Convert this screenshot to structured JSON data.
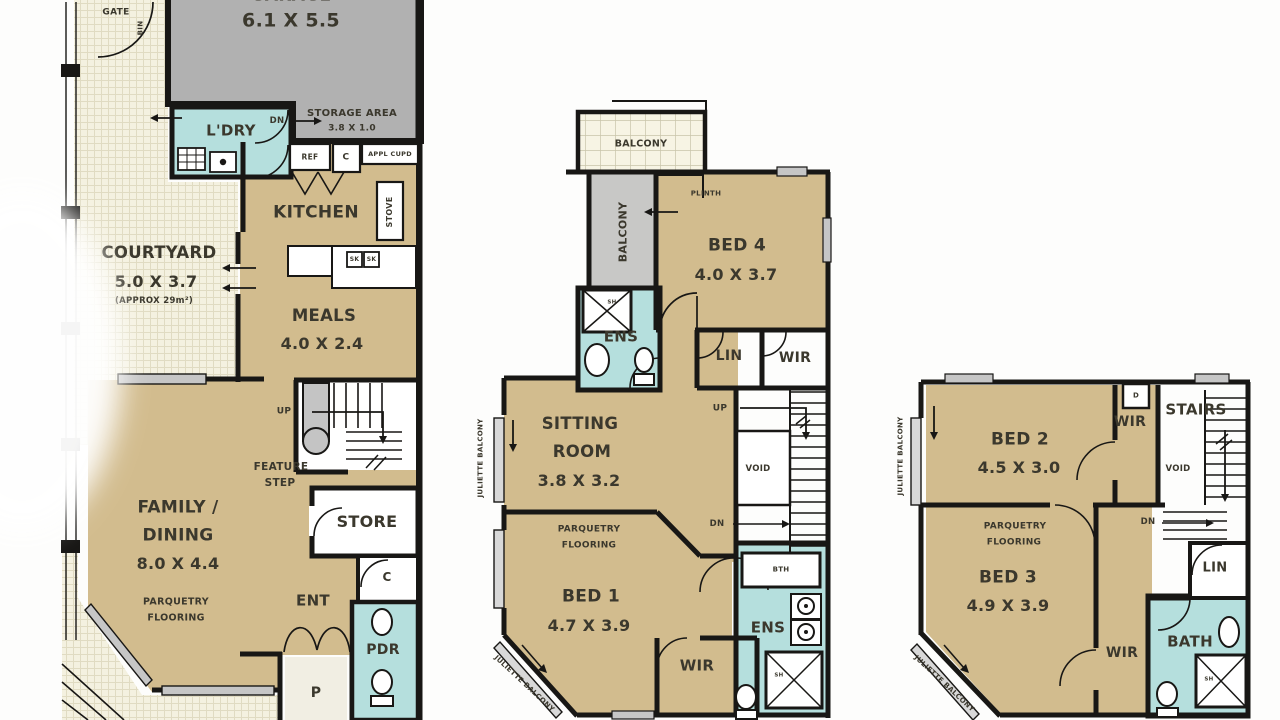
{
  "common": {
    "balcony": "BALCONY",
    "juliette": "JULIETTE BALCONY",
    "parquetry1": "PARQUETRY",
    "parquetry2": "FLOORING",
    "wir": "WIR",
    "ens": "ENS",
    "lin": "LIN",
    "void": "VOID",
    "up": "UP",
    "dn": "DN",
    "sh": "SH",
    "c": "C"
  },
  "ground": {
    "garage": "GARAGE",
    "garage_dims": "6.1 X 5.5",
    "gate": "GATE",
    "bin": "BIN",
    "storage_label": "STORAGE AREA",
    "storage_dims": "3.8 X 1.0",
    "laundry": "L'DRY",
    "ref": "REF",
    "appl_cupd": "APPL CUPD",
    "kitchen": "KITCHEN",
    "stove": "STOVE",
    "sk": "SK",
    "courtyard": "COURTYARD",
    "courtyard_dims": "5.0 X 3.7",
    "courtyard_approx": "(APPROX 29m²)",
    "meals": "MEALS",
    "meals_dims": "4.0 X 2.4",
    "feature1": "FEATURE",
    "feature2": "STEP",
    "family1": "FAMILY /",
    "family2": "DINING",
    "family_dims": "8.0 X 4.4",
    "store": "STORE",
    "ent": "ENT",
    "pdr": "PDR",
    "porch": "P"
  },
  "first": {
    "plinth": "PLINTH",
    "bed4": "BED 4",
    "bed4_dims": "4.0 X 3.7",
    "sitting1": "SITTING",
    "sitting2": "ROOM",
    "sitting_dims": "3.8 X 3.2",
    "bed1": "BED 1",
    "bed1_dims": "4.7 X 3.9",
    "bth": "BTH"
  },
  "second": {
    "bed2": "BED 2",
    "bed2_dims": "4.5 X 3.0",
    "d": "D",
    "stairs": "STAIRS",
    "bed3": "BED 3",
    "bed3_dims": "4.9 X 3.9",
    "bath": "BATH"
  },
  "colors": {
    "room_tan": "#d2bc8e",
    "wet_teal": "#b5dfdd",
    "garage_gray": "#b1b1b1",
    "balcony_gray": "#c8c8c6",
    "courtyard_cream": "#f4f1e0",
    "wall": "#181715",
    "label": "#3b382d"
  }
}
